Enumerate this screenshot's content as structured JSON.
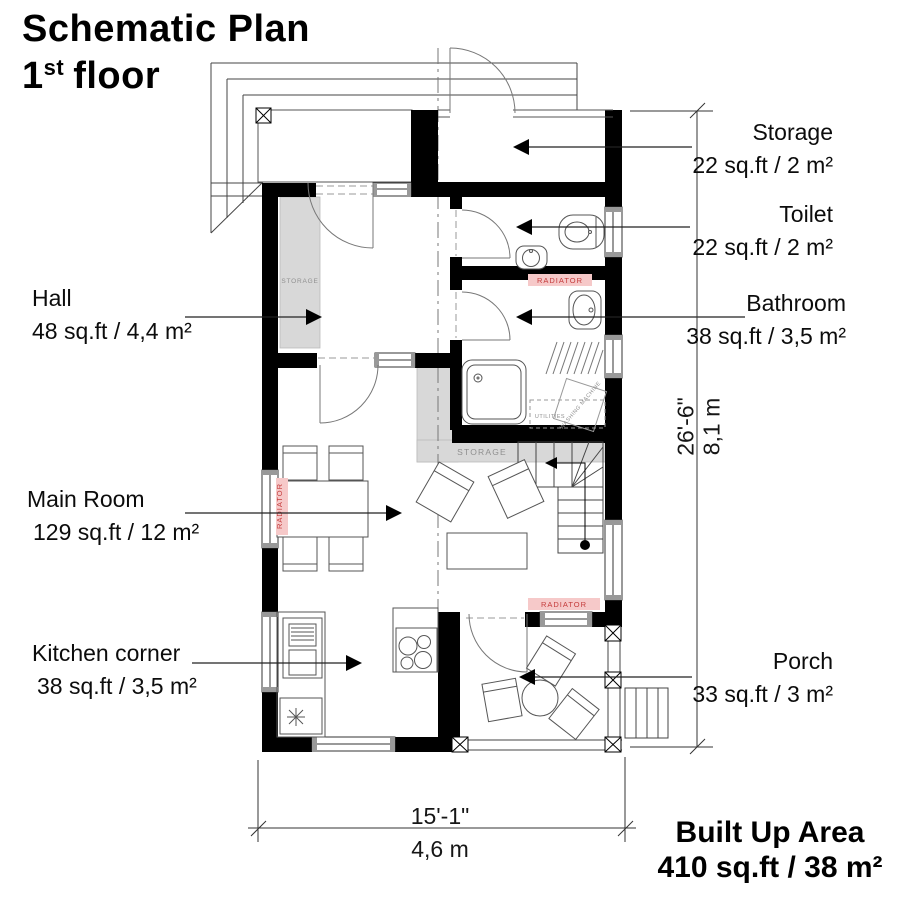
{
  "title": {
    "line1": "Schematic Plan",
    "floor_num": "1",
    "floor_sup": "st",
    "floor_rest": "floor"
  },
  "rooms": {
    "storage": {
      "name": "Storage",
      "area": "22 sq.ft / 2 m²"
    },
    "toilet": {
      "name": "Toilet",
      "area": "22 sq.ft / 2 m²"
    },
    "bathroom": {
      "name": "Bathroom",
      "area": "38 sq.ft / 3,5 m²"
    },
    "hall": {
      "name": "Hall",
      "area": "48 sq.ft / 4,4 m²"
    },
    "main_room": {
      "name": "Main Room",
      "area": "129 sq.ft / 12 m²"
    },
    "kitchen": {
      "name": "Kitchen corner",
      "area": "38 sq.ft / 3,5 m²"
    },
    "porch": {
      "name": "Porch",
      "area": "33 sq.ft / 3 m²"
    }
  },
  "dimensions": {
    "vertical_ft": "26'-6\"",
    "vertical_m": "8,1 m",
    "horizontal_ft": "15'-1\"",
    "horizontal_m": "4,6 m"
  },
  "summary": {
    "label": "Built Up Area",
    "value": "410 sq.ft / 38 m²"
  },
  "annotations": {
    "radiator": "RADIATOR",
    "closet": "STORAGE",
    "understairs": "STORAGE",
    "utilities": "UTILITIES",
    "washing_machine": "WASHING MACHINE"
  },
  "colors": {
    "wall": "#000000",
    "radiator_bg": "#f6c9c9",
    "radiator_text": "#c43b3b",
    "grey_fill": "#d8d8d8"
  }
}
